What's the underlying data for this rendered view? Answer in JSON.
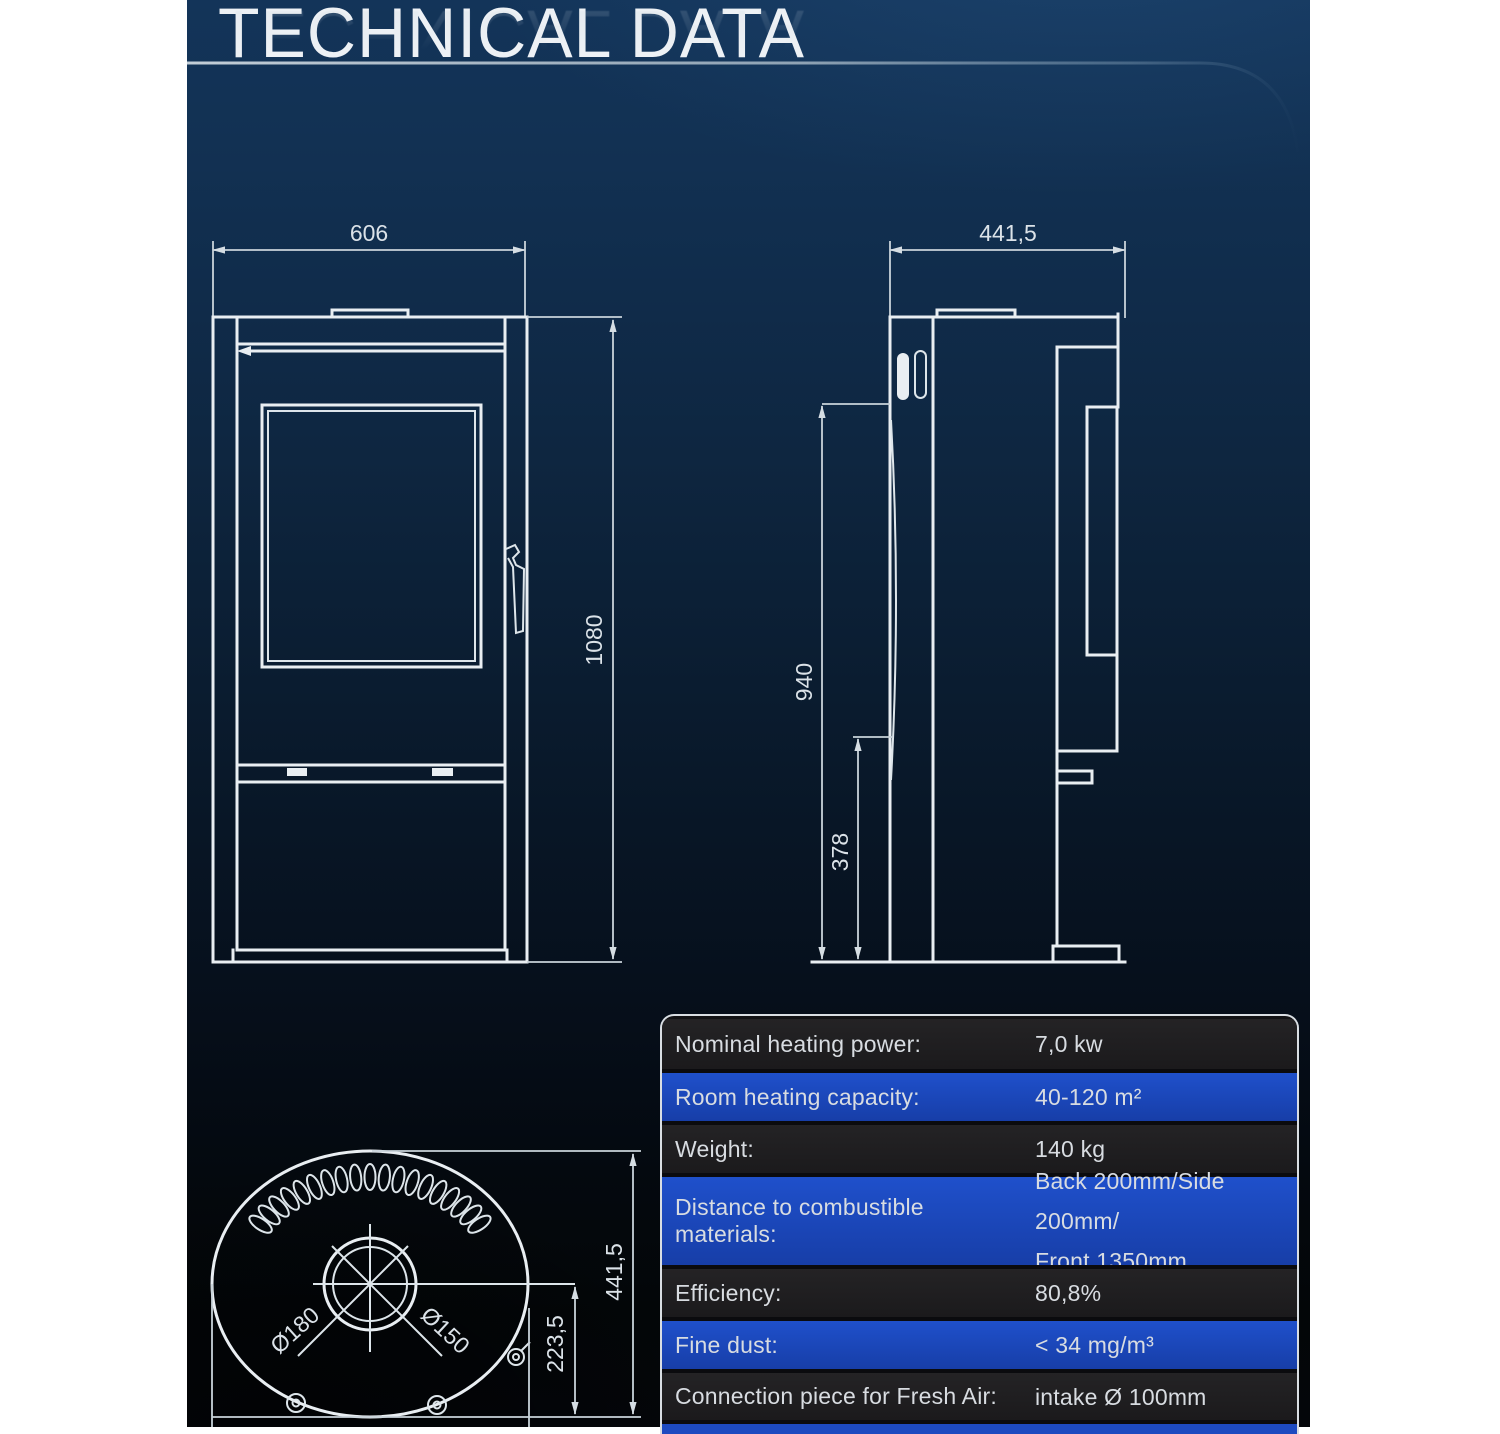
{
  "title": "TECHNICAL DATA",
  "drawings": {
    "front_view": {
      "width_label": "606",
      "height_label": "1080"
    },
    "side_view": {
      "depth_label": "441,5",
      "height_label": "940",
      "flue_height_label": "378"
    },
    "top_view": {
      "depth_label": "441,5",
      "flue_offset_label": "223,5",
      "outer_diameter_label": "Ø180",
      "inner_diameter_label": "Ø150"
    }
  },
  "table": {
    "rows": [
      {
        "label": "Nominal heating power:",
        "value": "7,0 kw"
      },
      {
        "label": "Room heating capacity:",
        "value": "40-120 m²"
      },
      {
        "label": "Weight:",
        "value": "140 kg"
      },
      {
        "label": "Distance to combustible materials:",
        "value": "Back 200mm/Side 200mm/",
        "value2": "Front 1350mm"
      },
      {
        "label": "Efficiency:",
        "value": "80,8%"
      },
      {
        "label": "Fine dust:",
        "value": "< 34 mg/m³"
      },
      {
        "label": "Connection piece for Fresh Air:",
        "value": "intake Ø 100mm"
      }
    ]
  },
  "colors": {
    "panel_top": "#133459",
    "panel_bottom": "#04060a",
    "line": "#e9eef2",
    "table_blue": "#1d4ac0",
    "table_dark": "#1f1e20",
    "table_border": "#d9dee3"
  }
}
